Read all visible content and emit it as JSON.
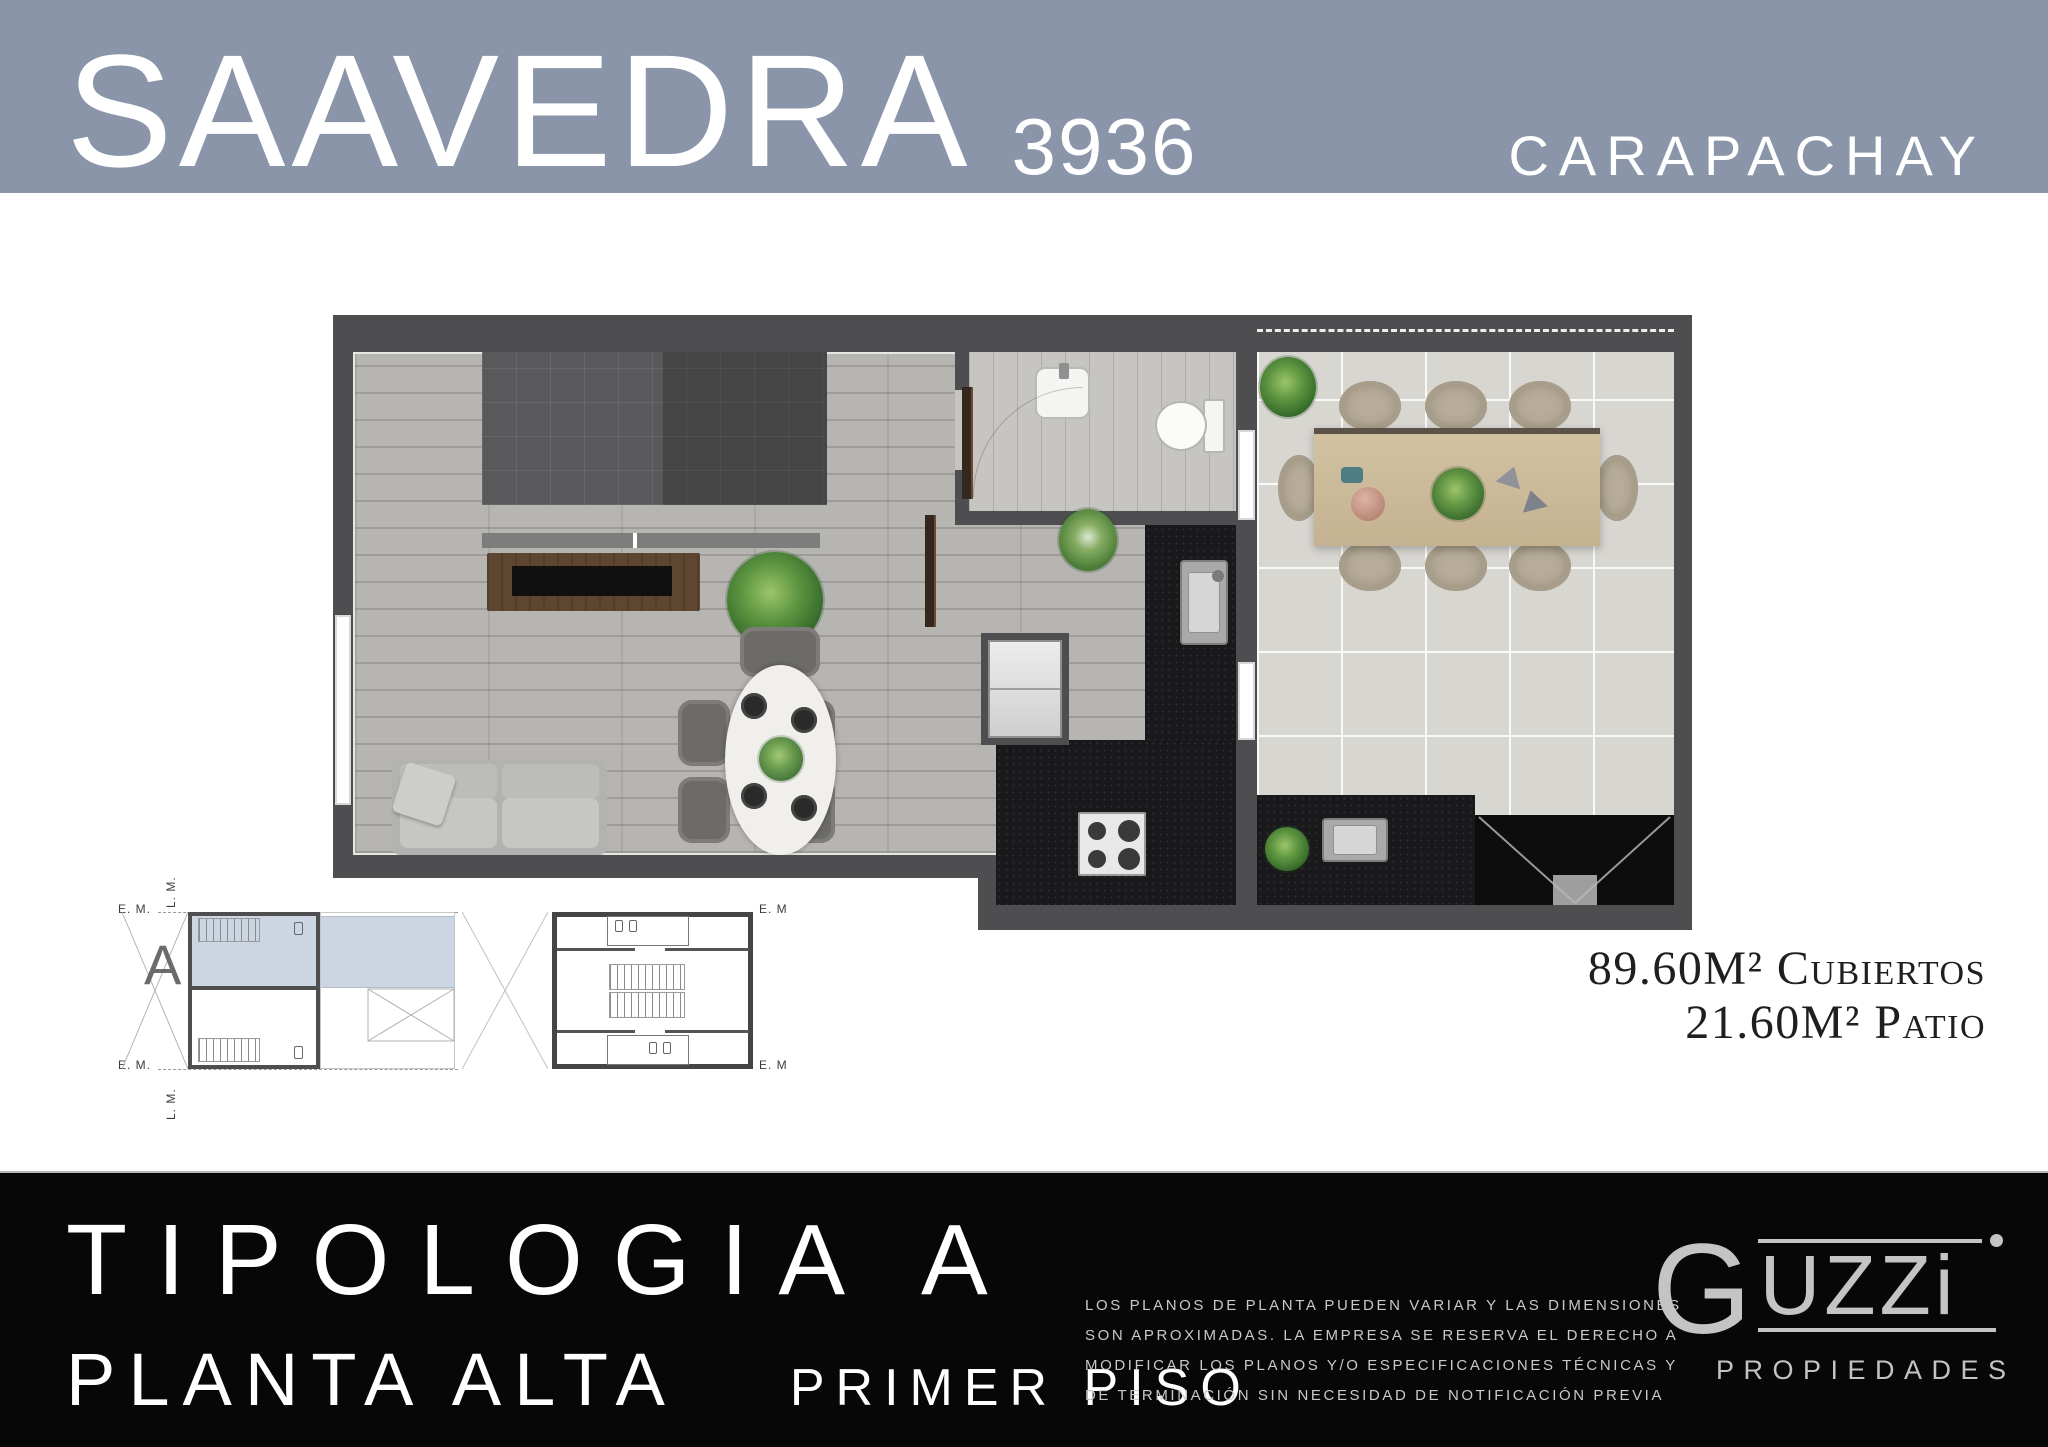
{
  "header": {
    "brand": "SAAVEDRA",
    "number": "3936",
    "location": "CARAPACHAY",
    "band_color": "#8a95aa",
    "text_color": "#ffffff"
  },
  "areas": {
    "covered_value": "89.60M²",
    "covered_label": "Cubiertos",
    "patio_value": "21.60M²",
    "patio_label": "Patio"
  },
  "schematics": {
    "unit_label": "A",
    "em_top": "E. M.",
    "lm_top": "L. M.",
    "em_bottom": "E. M.",
    "lm_bottom": "L. M.",
    "em_right_top": "E. M",
    "em_right_bottom": "E. M",
    "highlight_color": "#ccd5e2"
  },
  "plan": {
    "wall_color": "#4e4e50",
    "wood_floor_color": "#b7b5b2",
    "patio_tile_color": "#d8d6d1",
    "kitchen_counter_color": "#19191b",
    "rooms": [
      "living-dining",
      "bathroom",
      "kitchen",
      "patio"
    ]
  },
  "footer": {
    "title": "TIPOLOGIA",
    "title_suffix": "A",
    "subtitle": "PLANTA ALTA",
    "level": "PRIMER PISO",
    "disclaimer_lines": [
      "LOS PLANOS DE PLANTA PUEDEN VARIAR Y LAS DIMENSIONES",
      "SON APROXIMADAS. LA EMPRESA SE RESERVA EL DERECHO A",
      "MODIFICAR LOS PLANOS Y/O ESPECIFICACIONES TÉCNICAS Y",
      "DE TERMINACIÓN SIN NECESIDAD DE NOTIFICACIÓN PREVIA"
    ],
    "logo": {
      "g": "G",
      "rest": "UZZi",
      "sub": "PROPIEDADES"
    },
    "bg_color": "#070707"
  }
}
